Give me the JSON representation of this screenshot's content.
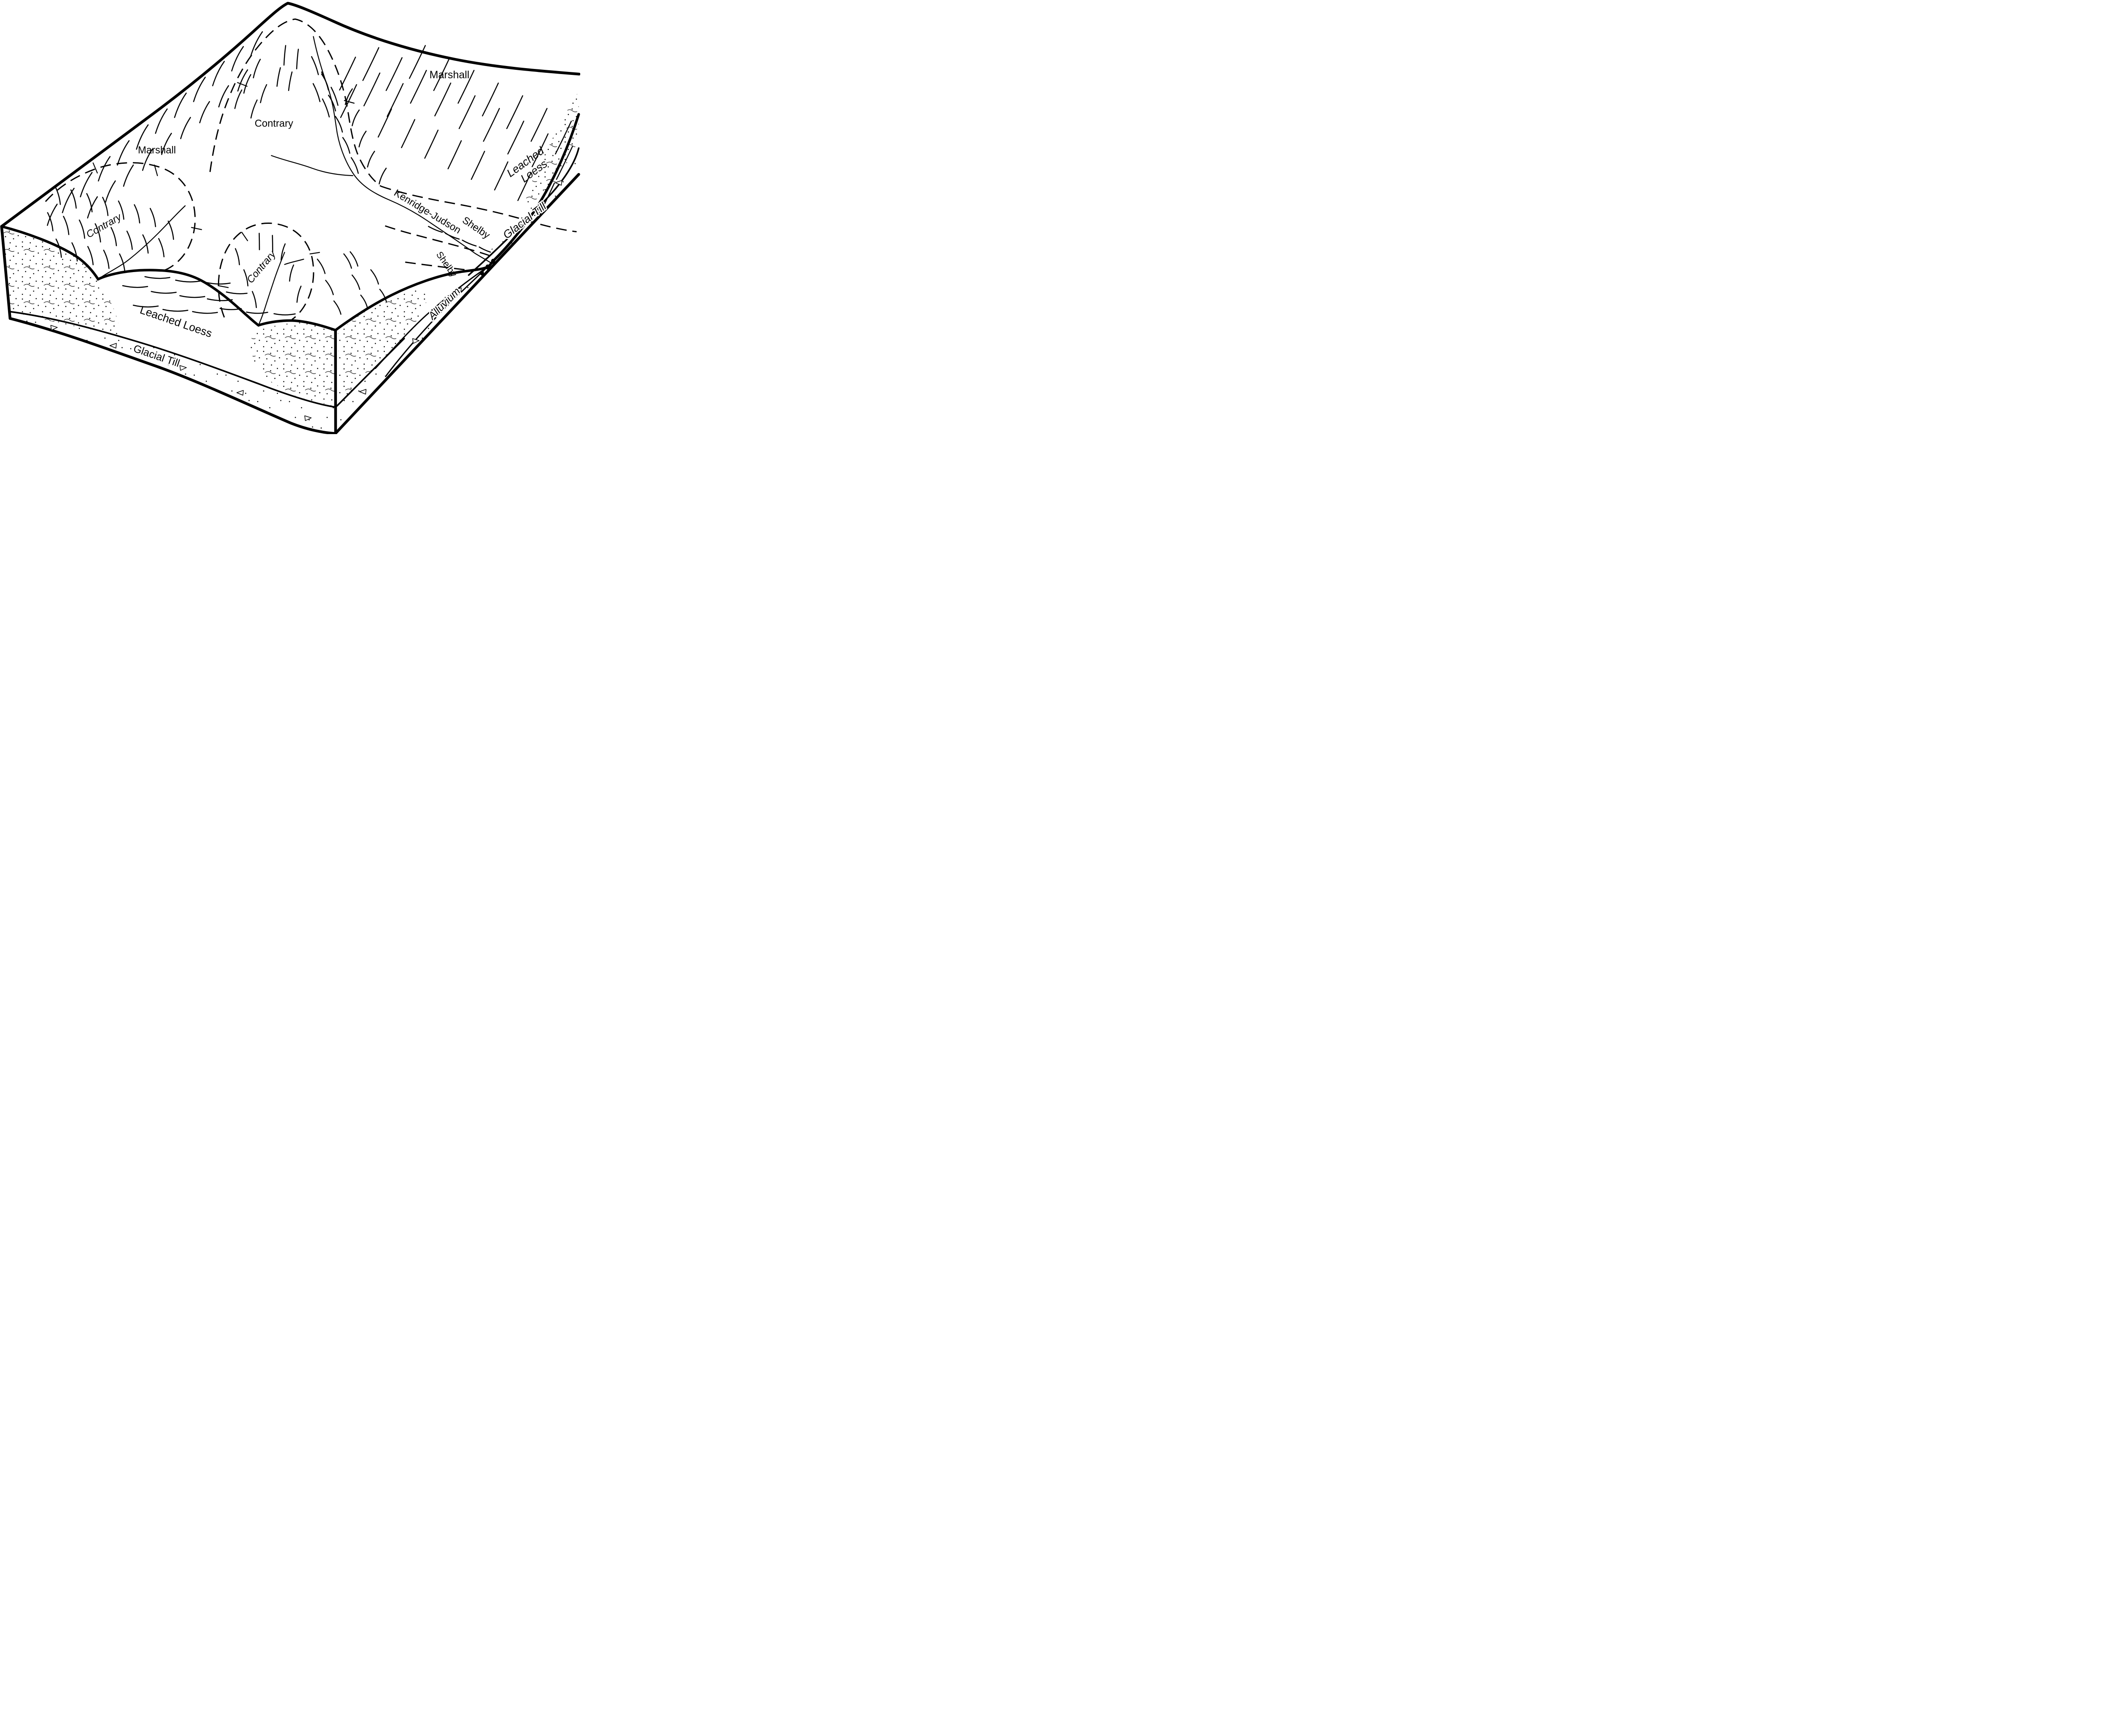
{
  "figure_kind": "soil-landscape block diagram",
  "colors": {
    "ink": "#000000",
    "paper": "#ffffff"
  },
  "soil_associations": [
    "Marshall",
    "Contrary",
    "Kenridge-Judson",
    "Shelby"
  ],
  "stratigraphy": [
    "Leached Loess",
    "Glacial Till",
    "Alluvium"
  ],
  "labels": {
    "marshall_right": "Marshall",
    "contrary_top": "Contrary",
    "marshall_left": "Marshall",
    "contrary_left": "Contrary",
    "contrary_bottom": "Contrary",
    "kenridge_judson": "Kenridge-Judson",
    "shelby_upper": "Shelby",
    "shelby_lower": "Shelby",
    "alluvium": "Alluvium",
    "leached_loess_right_line1": "Leached",
    "leached_loess_right_line2": "Loess",
    "glacial_till_right": "Glacial Till",
    "leached_loess_front": "Leached Loess",
    "glacial_till_front": "Glacial Till"
  }
}
